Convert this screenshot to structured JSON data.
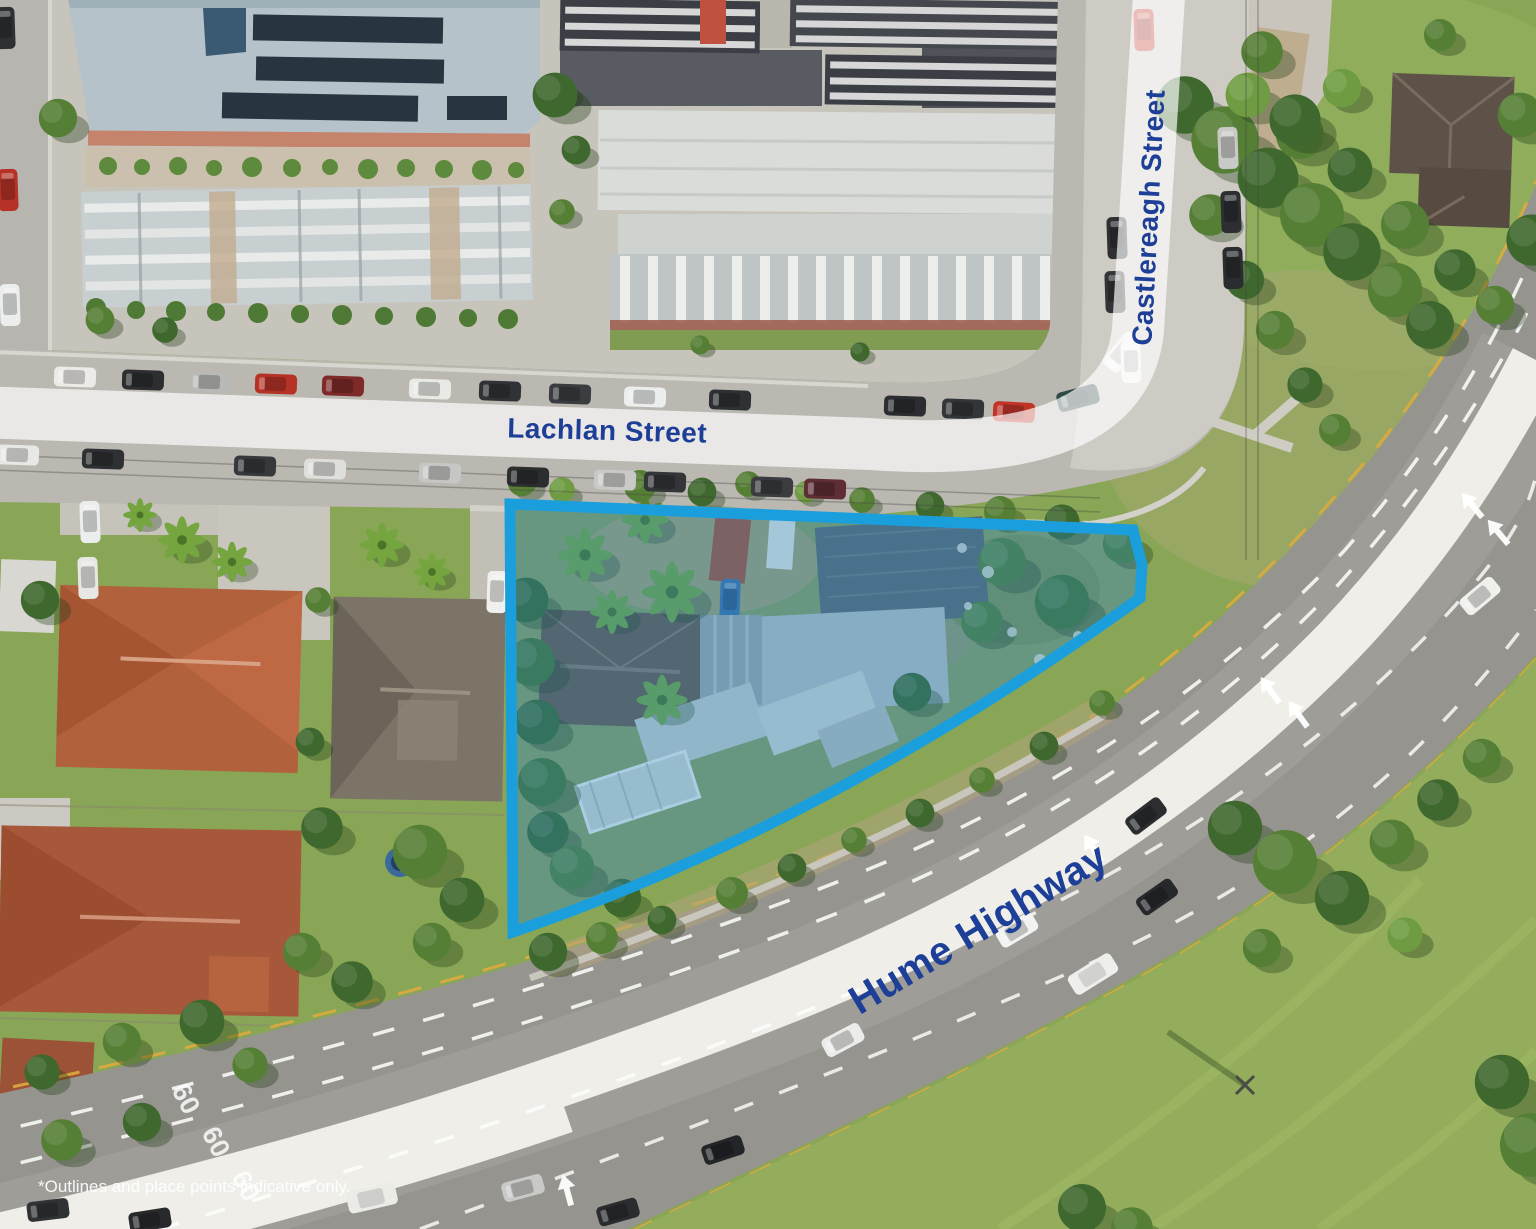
{
  "image": {
    "kind": "aerial-photograph",
    "description": "Aerial marketing photo of a development site bounded by Lachlan Street, Castlereagh Street and the Hume Highway, with a blue property outline"
  },
  "labels": {
    "lachlan_street": "Lachlan Street",
    "castlereagh_street": "Castlereagh Street",
    "hume_highway": "Hume Highway"
  },
  "road_markings": {
    "speed_60": "60"
  },
  "disclaimer": "*Outlines and place points indicative only.",
  "colors": {
    "street_label_text": "#1e3f97",
    "label_band": "rgba(255,255,255,0.68)",
    "property_outline": "#1b9fdc",
    "property_fill": "rgba(32,138,202,0.32)",
    "asphalt_highway": "#96948e",
    "asphalt_street": "#bab8b1",
    "median_white": "#efeee9",
    "grass": "#88a655",
    "kerb_yellow": "#ddab3f",
    "disclaimer_text": "rgba(255,255,255,0.92)"
  }
}
